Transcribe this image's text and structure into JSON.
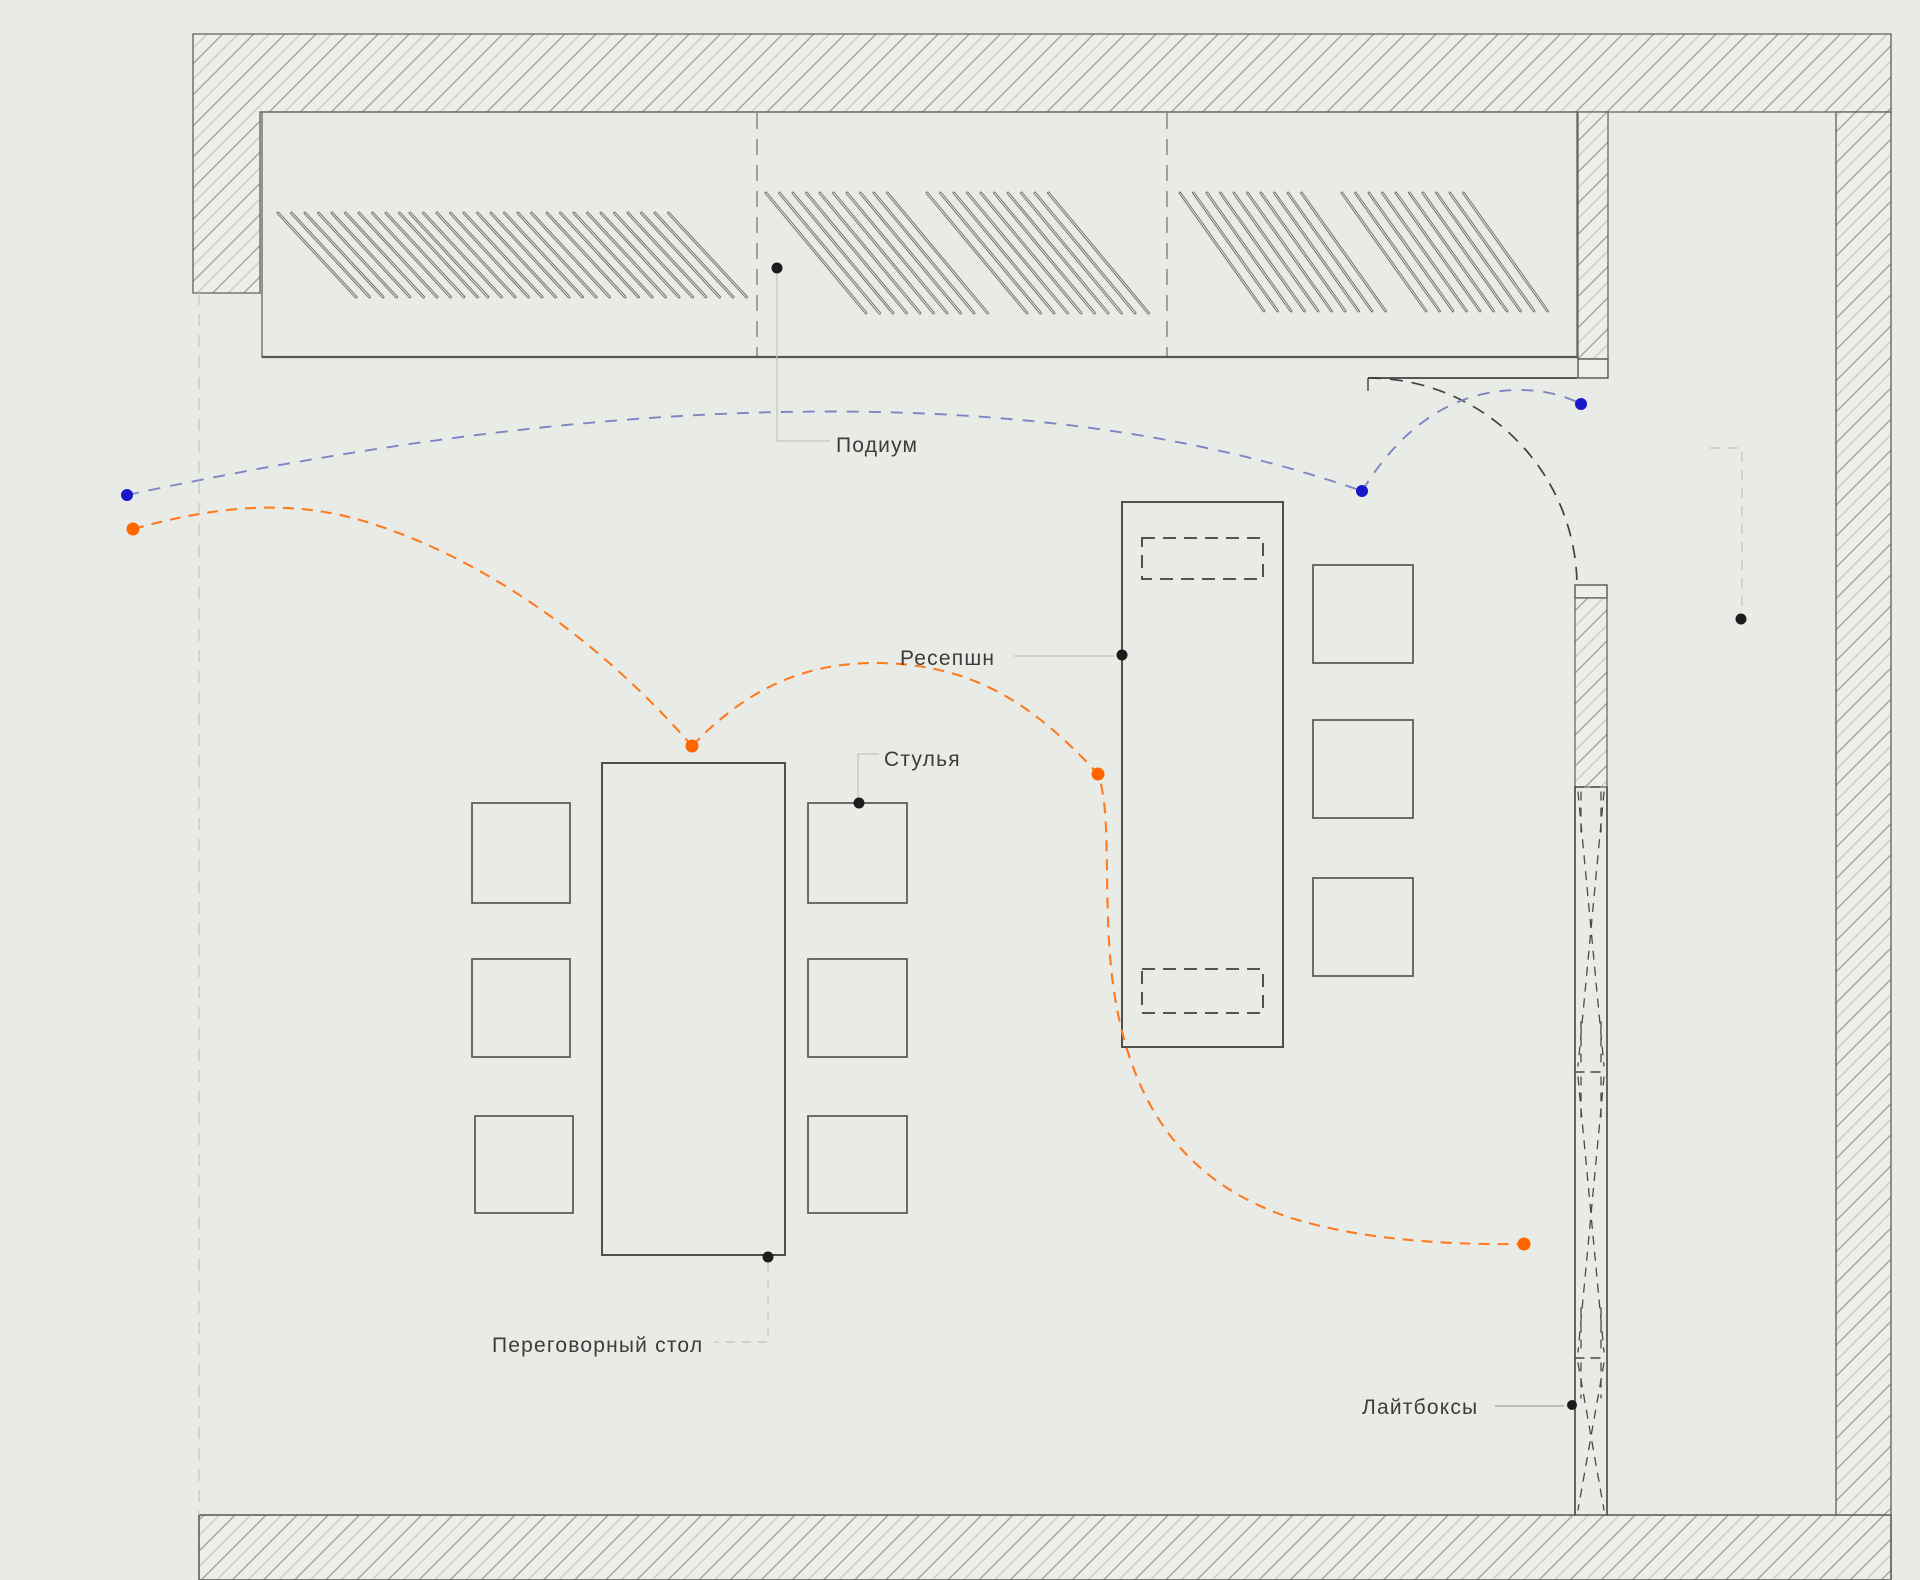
{
  "drawing_type": "interior floor plan with circulation flows",
  "labels": {
    "podium": "Подиум",
    "reception": "Ресепшн",
    "chairs": "Стулья",
    "meeting_table": "Переговорный стол",
    "lightboxes": "Лайтбоксы"
  },
  "colors": {
    "background": "#e9ece6",
    "wall_line": "#5f5f5f",
    "hatch_dark": "#979797",
    "hatch_light": "#c6c6c6",
    "furniture_line": "#565656",
    "louver_line": "#6e6e6e",
    "flow_orange": "#ff7a1f",
    "flow_blue": "#7e84c4",
    "marker_black": "#1c1c1c",
    "marker_blue": "#1a17c9",
    "marker_orange": "#ff6600",
    "label_text": "#3c3c3c",
    "leader_line": "#c2c6bb"
  },
  "markers": {
    "black": [
      {
        "name": "podium-anchor",
        "x": 777,
        "y": 268
      },
      {
        "name": "reception-anchor",
        "x": 1122,
        "y": 655
      },
      {
        "name": "chairs-anchor",
        "x": 859,
        "y": 803
      },
      {
        "name": "meeting-table-anchor",
        "x": 768,
        "y": 1257
      },
      {
        "name": "lightboxes-anchor",
        "x": 1572,
        "y": 1405
      },
      {
        "name": "unlabeled-anchor",
        "x": 1741,
        "y": 619
      }
    ],
    "blue": [
      {
        "name": "flow-blue-start",
        "x": 127,
        "y": 495
      },
      {
        "name": "flow-blue-mid",
        "x": 1362,
        "y": 491
      },
      {
        "name": "flow-blue-end",
        "x": 1581,
        "y": 404
      }
    ],
    "orange": [
      {
        "name": "flow-orange-start",
        "x": 133,
        "y": 529
      },
      {
        "name": "flow-orange-table",
        "x": 692,
        "y": 746
      },
      {
        "name": "flow-orange-reception",
        "x": 1098,
        "y": 774
      },
      {
        "name": "flow-orange-end",
        "x": 1524,
        "y": 1244
      }
    ]
  },
  "drawing": {
    "louver_groups": [
      {
        "x0": 278,
        "y0": 213,
        "dx": 78,
        "dy": 84,
        "step": 13.5,
        "count": 10
      },
      {
        "x0": 410,
        "y0": 213,
        "dx": 78,
        "dy": 84,
        "step": 13.5,
        "count": 10
      },
      {
        "x0": 547,
        "y0": 213,
        "dx": 78,
        "dy": 84,
        "step": 13.5,
        "count": 10
      },
      {
        "x0": 766,
        "y0": 193,
        "dx": 100,
        "dy": 120,
        "step": 13.5,
        "count": 10
      },
      {
        "x0": 927,
        "y0": 193,
        "dx": 100,
        "dy": 120,
        "step": 13.5,
        "count": 10
      },
      {
        "x0": 1180,
        "y0": 193,
        "dx": 84,
        "dy": 118,
        "step": 13.5,
        "count": 10
      },
      {
        "x0": 1342,
        "y0": 193,
        "dx": 84,
        "dy": 118,
        "step": 13.5,
        "count": 10
      }
    ]
  }
}
